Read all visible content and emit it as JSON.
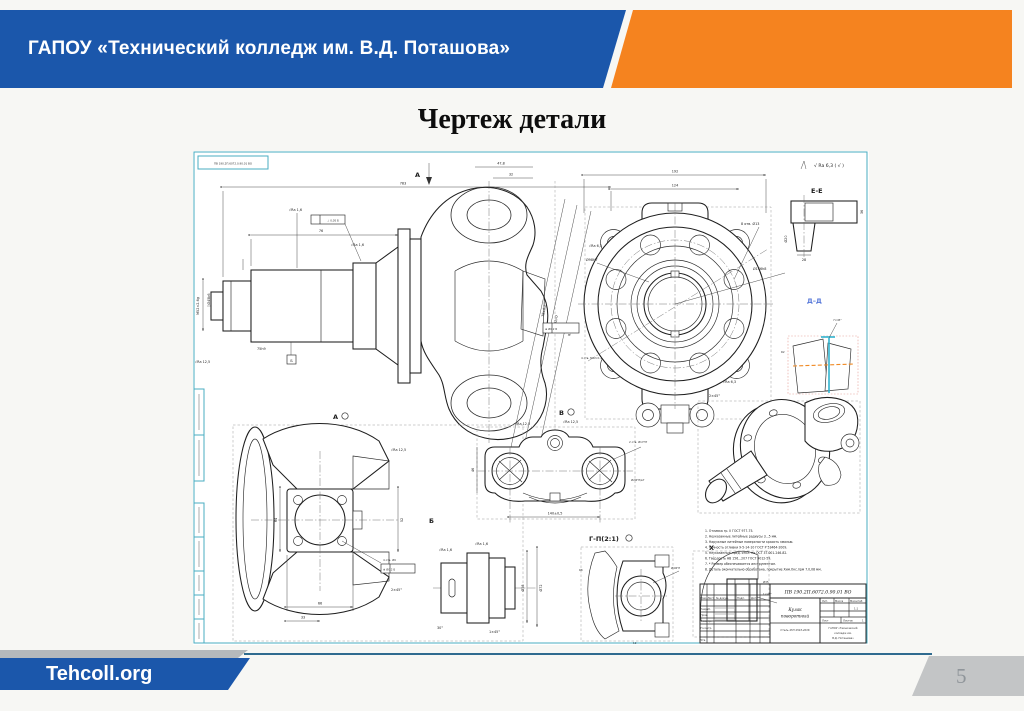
{
  "header": {
    "org_name": "ГАПОУ «Технический колледж им. В.Д. Поташова»"
  },
  "title": "Чертеж детали",
  "footer": {
    "site": "Tehcoll.org",
    "page_number": "5"
  },
  "colors": {
    "header_blue": "#1b57ab",
    "accent_orange": "#f5831f",
    "frame_cyan": "#49acc2",
    "highlight_cyan": "#2fb3cf",
    "highlight_orange": "#f08a24",
    "label_blue": "#5577d9",
    "footer_line": "#2f6b8f",
    "badge_gray": "#c3c5c6"
  },
  "drawing": {
    "stamp": "ПВ 190.2П.6072.0.90.01 ВО",
    "corner_roughness": "√ Ra 6,3 ( √ )",
    "views": {
      "a": "А",
      "b": "Б",
      "v": "В",
      "g": "Г-П(2:1)",
      "e": "Е-Е",
      "d": "Д–Д",
      "x": "Х"
    },
    "dims": {
      "d783": "783",
      "d76": "76",
      "d478": "47,8",
      "d32": "32",
      "m52": "М52×2-6g",
      "d45": "Ø45k6",
      "ra16": "√Ra 1,6",
      "ra125": "√Ra 12,5",
      "tol1": "⊥ 0,05 Б",
      "d75": "75h9",
      "f192": "192",
      "f124": "124",
      "f8otv": "8 отв. Ø13",
      "f146": "Ø146h8",
      "fra63": "√Ra 6,3",
      "f98": "Ø98H7",
      "f245": "2×45°",
      "s78": "78±0,2",
      "s52": "Ø52H7",
      "sr12": "R12",
      "stol": "⊕ Ø0,2 Б",
      "sm12": "4 отв. М12×1,25-7Н",
      "a66": "66",
      "a33": "33",
      "a64": "64",
      "a52": "52",
      "a9": "4 отв. Ø9",
      "v140": "140±0,5",
      "v17": "2 отв. Ø17Н7",
      "v46": "46",
      "v20": "Ø20H7/в7",
      "b72": "Ø72",
      "b58": "Ø58",
      "b145": "1×45°",
      "b30": "30°",
      "g40": "Ø40Н7",
      "gr8": "R8",
      "g12": "12",
      "x35": "Ø35",
      "e20": "Ø20",
      "e28": "28",
      "e36": "36",
      "dd745": "7×45°",
      "ddr2": "R2"
    },
    "notes": [
      "1. Отливка гр. II ГОСТ 977-75.",
      "2. Неуказанные литейные радиусы 3...5 мм.",
      "3. Наружные литейные поверхности красить эмалью.",
      "4. Точность отливки 9-5-14-10 ГОСТ Р 53464-2009.",
      "5. Неуказанные пред. откл. по ОСТ 37.001.246-82.",
      "6. Твёрдость НВ 156...207 ГОСТ 9012-59.",
      "7. * Размер обеспечивается инструментом.",
      "8. Деталь окончательно обработана, покрытие Хим.Окс.прм 7.0,08 мм."
    ],
    "title_block": {
      "doc_number": "ПВ 190.2П.6072.0.90.01 ВО",
      "name1": "Кулак",
      "name2": "поворотный",
      "material": "Сталь 45Л 4543-2016",
      "lit": "Лит.",
      "mass": "Масса",
      "scale": "Масштаб",
      "scale_v": "1:1",
      "sheet": "Лист",
      "sheets": "Листов",
      "sheet_no": "1",
      "org1": "ГАПОУ «Технический",
      "org2": "колледж им.",
      "org3": "В.Д. Поташова»",
      "izm": "Изм.",
      "list": "Лист",
      "dok": "№ докум.",
      "podp": "Подп.",
      "data": "Дата",
      "razrab": "Разраб.",
      "prov": "Пров.",
      "tkontr": "Т.контр.",
      "nkontr": "Н.контр.",
      "utv": "Утв."
    }
  }
}
